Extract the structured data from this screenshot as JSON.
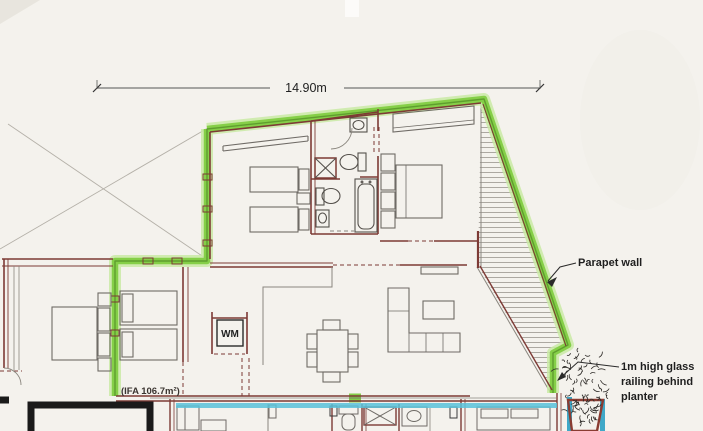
{
  "drawing": {
    "kind": "architectural floor plan",
    "dimension": {
      "label": "14.90m"
    },
    "annotations": {
      "parapet": "Parapet wall",
      "railing_lines": [
        "1m high glass",
        "railing behind",
        "planter"
      ],
      "ifa": "(IFA 106.7m²)"
    },
    "fixtures": {
      "washing_machine": "WM"
    },
    "colors": {
      "paper": "#f4f2ed",
      "parapet_green": "#85cf48",
      "parapet_green_glow": "#c9eaa4",
      "parapet_green_core": "#5f9e2e",
      "wall_maroon": "#7d3a35",
      "furniture_gray": "#6f6b66",
      "structure_gray": "#8a867e",
      "glass_cyan": "#58c2d9",
      "heavy_black": "#1a1a1a",
      "hatch_gray": "#9a968e",
      "label_ink": "#1f1f1f"
    }
  }
}
